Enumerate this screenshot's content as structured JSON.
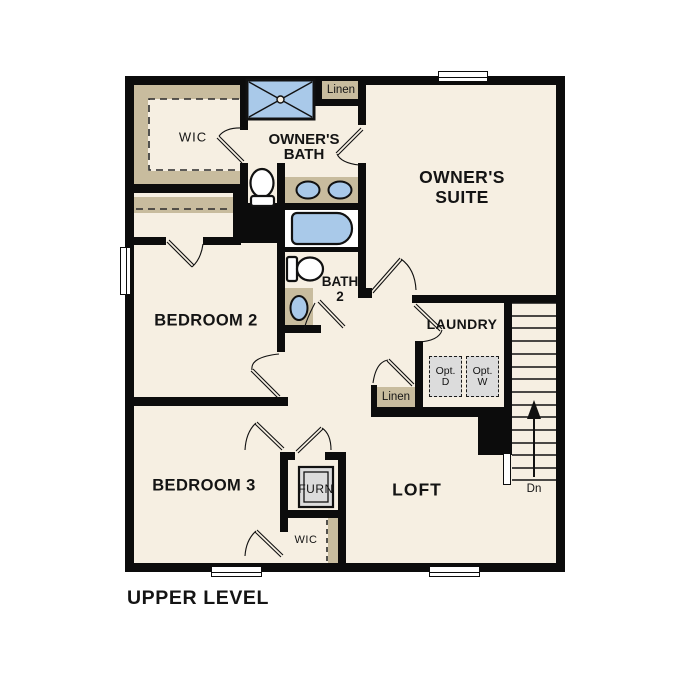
{
  "page_title": "UPPER LEVEL",
  "colors": {
    "wall": "#0c0c0c",
    "floor": "#f6efe2",
    "casework_tan": "#c8bc9e",
    "fixture_blue": "#a9c9e9",
    "appliance_gray": "#dcdcdc"
  },
  "rooms": {
    "owner_suite": {
      "line1": "OWNER'S",
      "line2": "SUITE"
    },
    "owner_bath": {
      "line1": "OWNER'S",
      "line2": "BATH"
    },
    "bedroom_2": {
      "label": "BEDROOM 2"
    },
    "bedroom_3": {
      "label": "BEDROOM 3"
    },
    "bath_2": {
      "line1": "BATH",
      "line2": "2"
    },
    "laundry": {
      "label": "LAUNDRY"
    },
    "loft": {
      "label": "LOFT"
    }
  },
  "closets": {
    "owner_wic": {
      "label": "WIC"
    },
    "linen_bath": {
      "label": "Linen"
    },
    "linen_hall": {
      "label": "Linen"
    },
    "bedroom3_wic": {
      "label": "WIC"
    },
    "furnace": {
      "label": "FURN"
    }
  },
  "appliances": {
    "optional_dryer": {
      "line1": "Opt.",
      "line2": "D"
    },
    "optional_washer": {
      "line1": "Opt.",
      "line2": "W"
    }
  },
  "stairs": {
    "down_label": "Dn"
  }
}
